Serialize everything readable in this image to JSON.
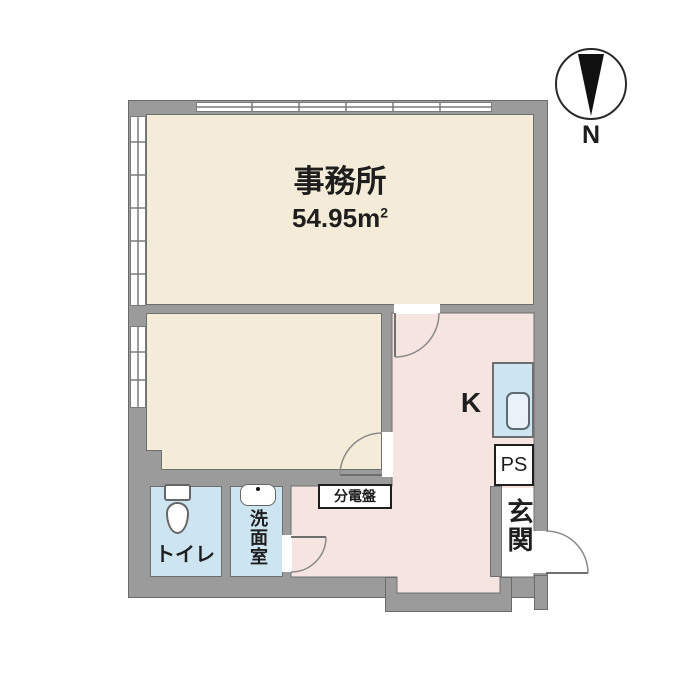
{
  "compass": {
    "north_label": "N"
  },
  "office": {
    "name": "事務所",
    "area_value": "54.95",
    "area_unit": "m",
    "area_sup": "2"
  },
  "kitchen": {
    "label": "K"
  },
  "pipe_space": {
    "label": "PS"
  },
  "entrance": {
    "label": "玄関"
  },
  "toilet": {
    "label": "トイレ"
  },
  "washroom": {
    "label": "洗面室"
  },
  "distribution_board": {
    "label": "分電盤"
  },
  "colors": {
    "wall_gray": "#9b9b9b",
    "room_beige": "#f4ecd8",
    "hall_pink": "#f6e4e1",
    "wet_area_blue": "#cde4f1",
    "fixture_white": "#ffffff",
    "line_dark": "#6f6f6f"
  }
}
